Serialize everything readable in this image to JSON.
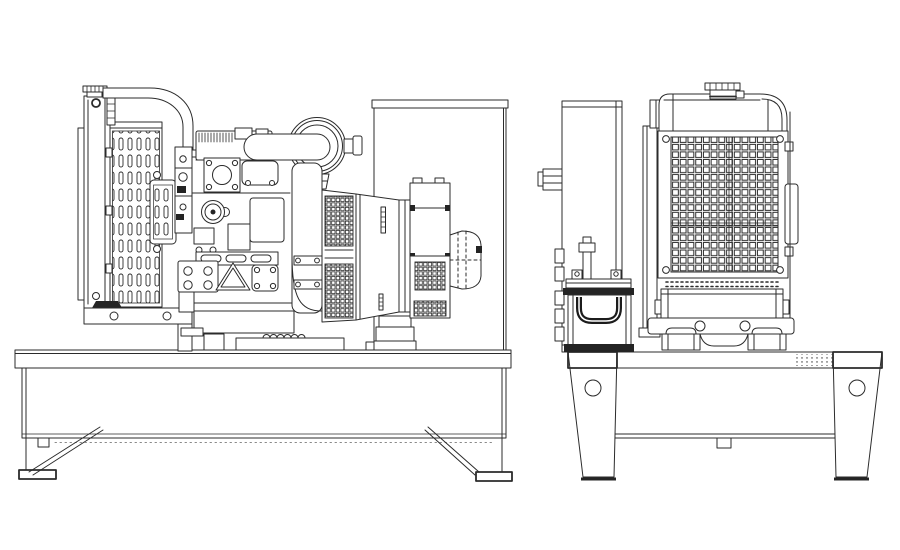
{
  "document": {
    "title": "Open diesel generator set - outline drawing",
    "background_color": "#ffffff",
    "line_color": "#2b2b2b"
  },
  "views": {
    "side_view": {
      "label": "Side view",
      "parts": {
        "rear_panel": "Rear mounting panel",
        "base_frame": "Base frame skid with legs",
        "radiator": "Radiator with louvered fan shroud",
        "upper_hose": "Upper coolant hose",
        "engine": "Diesel engine block",
        "air_cleaner": "Air cleaner canister",
        "flywheel_housing": "Flywheel housing",
        "alternator": "Alternator with vent grilles",
        "terminal_box": "Alternator terminal box"
      }
    },
    "front_view": {
      "label": "Front view",
      "parts": {
        "pillar": "Side support pillar",
        "battery": "Starter battery with handle",
        "radiator_front": "Radiator core grille with filler cap",
        "base_frame": "Base frame cross member with drilled legs"
      }
    }
  }
}
